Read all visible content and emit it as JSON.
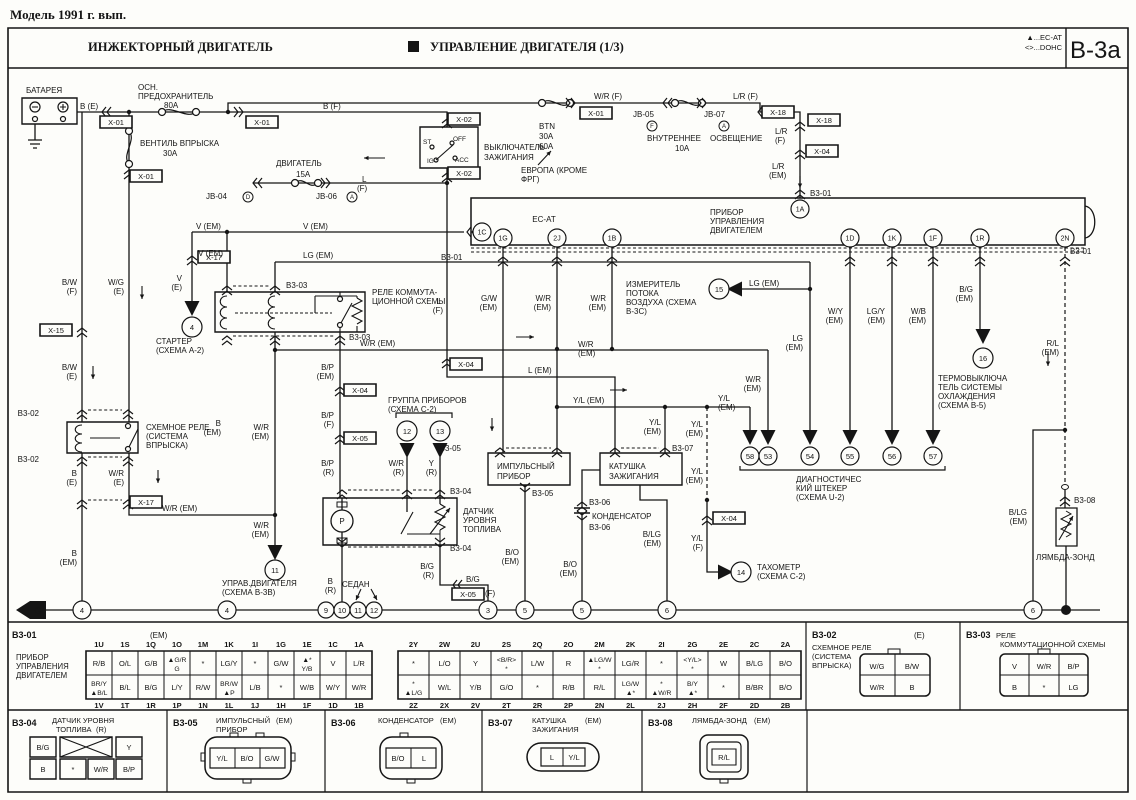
{
  "page": {
    "title": "Модель 1991 г. вып."
  },
  "header": {
    "left": "ИНЖЕКТОРНЫЙ ДВИГАТЕЛЬ",
    "center": "УПРАВЛЕНИЕ ДВИГАТЕЛЯ (1/3)",
    "legend1": "▲...EC-AT",
    "legend2": "<>...DOHC",
    "code": "B-3a"
  },
  "diagram": {
    "labels": [
      [
        "БАТАРЕЯ",
        26,
        93
      ],
      [
        "ОСН.",
        138,
        90
      ],
      [
        "ПРЕДОХРАНИТЕЛЬ",
        138,
        99
      ],
      [
        "80A",
        164,
        108
      ],
      [
        "B (E)",
        80,
        109
      ],
      [
        "B (F)",
        323,
        109
      ],
      [
        "ВЕНТИЛЬ ВПРЫСКА",
        140,
        146
      ],
      [
        "30A",
        163,
        156
      ],
      [
        "ДВИГАТЕЛЬ",
        276,
        166
      ],
      [
        "15A",
        296,
        177
      ],
      [
        "JB-04",
        206,
        199
      ],
      [
        "JB-06",
        316,
        199
      ],
      [
        "L",
        362,
        182
      ],
      [
        "(F)",
        357,
        191
      ],
      [
        "W/R (F)",
        594,
        99
      ],
      [
        "L/R (F)",
        733,
        99
      ],
      [
        "BTN",
        539,
        129
      ],
      [
        "30A",
        539,
        139
      ],
      [
        "60A",
        539,
        149
      ],
      [
        "ЕВРОПА (КРОМЕ",
        521,
        173
      ],
      [
        "ФРГ)",
        521,
        182
      ],
      [
        "JB-05",
        633,
        117
      ],
      [
        "JB-07",
        704,
        117
      ],
      [
        "ВНУТРЕННЕЕ",
        647,
        141
      ],
      [
        "ОСВЕЩЕНИЕ",
        710,
        141
      ],
      [
        "10A",
        675,
        151
      ],
      [
        "ВЫКЛЮЧАТЕЛЬ",
        484,
        150
      ],
      [
        "ЗАЖИГАНИЯ",
        484,
        160
      ],
      [
        "ST",
        423,
        144,
        "s",
        6.5
      ],
      [
        "IG",
        427,
        163,
        "s",
        6.5
      ],
      [
        "OFF",
        453,
        141,
        "s",
        6.5
      ],
      [
        "ACC",
        455,
        162,
        "s",
        6.5
      ],
      [
        "L/R",
        775,
        134
      ],
      [
        "(F)",
        775,
        143
      ],
      [
        "L/R",
        772,
        169
      ],
      [
        "(EM)",
        769,
        178
      ],
      [
        "B3-01",
        810,
        196
      ],
      [
        "EC-AT",
        544,
        222,
        "m"
      ],
      [
        "ПРИБОР",
        710,
        215
      ],
      [
        "УПРАВЛЕНИЯ",
        710,
        224
      ],
      [
        "ДВИГАТЕЛЕМ",
        710,
        233
      ],
      [
        "B3-01",
        441,
        260
      ],
      [
        "B3-01",
        1070,
        254
      ],
      [
        "V (EM)",
        196,
        229
      ],
      [
        "V (EM)",
        303,
        229
      ],
      [
        "V (EM)",
        223,
        256,
        "e"
      ],
      [
        "V",
        182,
        281,
        "e"
      ],
      [
        "(E)",
        182,
        290,
        "e"
      ],
      [
        "СТАРТЕР",
        156,
        344
      ],
      [
        "(СХЕМА A-2)",
        156,
        353
      ],
      [
        "B/W",
        77,
        285,
        "e"
      ],
      [
        "(F)",
        77,
        294,
        "e"
      ],
      [
        "W/G",
        124,
        285,
        "e"
      ],
      [
        "(E)",
        124,
        294,
        "e"
      ],
      [
        "B/W",
        77,
        370,
        "e"
      ],
      [
        "(E)",
        77,
        379,
        "e"
      ],
      [
        "B3-02",
        39,
        416,
        "e"
      ],
      [
        "СХЕМНОЕ РЕЛЕ",
        146,
        430
      ],
      [
        "(СИСТЕМА",
        146,
        439
      ],
      [
        "ВПРЫСКА)",
        146,
        448
      ],
      [
        "B3-02",
        39,
        462,
        "e"
      ],
      [
        "B",
        77,
        476,
        "e"
      ],
      [
        "(E)",
        77,
        485,
        "e"
      ],
      [
        "W/R",
        124,
        476,
        "e"
      ],
      [
        "(E)",
        124,
        485,
        "e"
      ],
      [
        "W/R (EM)",
        162,
        511
      ],
      [
        "B",
        77,
        556,
        "e"
      ],
      [
        "(EM)",
        77,
        565,
        "e"
      ],
      [
        "B",
        221,
        426,
        "e"
      ],
      [
        "(EM)",
        221,
        435,
        "e"
      ],
      [
        "W/R",
        269,
        430,
        "e"
      ],
      [
        "(EM)",
        269,
        439,
        "e"
      ],
      [
        "W/R",
        269,
        528,
        "e"
      ],
      [
        "(EM)",
        269,
        537,
        "e"
      ],
      [
        "УПРАВ.ДВИГАТЕЛЯ",
        222,
        586
      ],
      [
        "(СХЕМА B-3B)",
        222,
        595
      ],
      [
        "B3-03",
        286,
        288
      ],
      [
        "B3-03",
        349,
        340
      ],
      [
        "РЕЛЕ КОММУТА-",
        372,
        295
      ],
      [
        "ЦИОННОЙ СХЕМЫ",
        372,
        304
      ],
      [
        "LG (EM)",
        303,
        258
      ],
      [
        "W/R (EM)",
        360,
        346
      ],
      [
        "B/P",
        334,
        370,
        "e"
      ],
      [
        "(EM)",
        334,
        379,
        "e"
      ],
      [
        "B/P",
        334,
        418,
        "e"
      ],
      [
        "(F)",
        334,
        427,
        "e"
      ],
      [
        "B/P",
        334,
        466,
        "e"
      ],
      [
        "(R)",
        334,
        475,
        "e"
      ],
      [
        "L",
        441,
        304,
        "e"
      ],
      [
        "(F)",
        443,
        313,
        "e"
      ],
      [
        "G/W",
        497,
        301,
        "e"
      ],
      [
        "(EM)",
        497,
        310,
        "e"
      ],
      [
        "W/R",
        551,
        301,
        "e"
      ],
      [
        "(EM)",
        551,
        310,
        "e"
      ],
      [
        "W/R",
        606,
        301,
        "e"
      ],
      [
        "(EM)",
        606,
        310,
        "e"
      ],
      [
        "W/R",
        578,
        347
      ],
      [
        "(EM)",
        578,
        356
      ],
      [
        "L (EM)",
        528,
        373
      ],
      [
        "ГРУППА ПРИБОРОВ",
        388,
        403
      ],
      [
        "(СХЕМА C-2)",
        388,
        412
      ],
      [
        "W/R",
        404,
        466,
        "e"
      ],
      [
        "(R)",
        404,
        475,
        "e"
      ],
      [
        "Y",
        434,
        466,
        "e"
      ],
      [
        "(R)",
        437,
        475,
        "e"
      ],
      [
        "B3-04",
        450,
        494
      ],
      [
        "B3-04",
        450,
        551
      ],
      [
        "ДАТЧИК",
        463,
        514
      ],
      [
        "УРОВНЯ",
        463,
        523
      ],
      [
        "ТОПЛИВА",
        463,
        532
      ],
      [
        "B/G",
        434,
        569,
        "e"
      ],
      [
        "(R)",
        434,
        578,
        "e"
      ],
      [
        "B",
        333,
        584,
        "e"
      ],
      [
        "(R)",
        336,
        593,
        "e"
      ],
      [
        "СЕДАН",
        342,
        587
      ],
      [
        "B/G",
        466,
        582
      ],
      [
        "(F)",
        485,
        596
      ],
      [
        "B3-05",
        461,
        451,
        "e"
      ],
      [
        "ИМПУЛЬСНЫЙ",
        497,
        469
      ],
      [
        "ПРИБОР",
        497,
        479
      ],
      [
        "B3-05",
        532,
        496
      ],
      [
        "B/O",
        519,
        555,
        "e"
      ],
      [
        "(EM)",
        519,
        564,
        "e"
      ],
      [
        "КАТУШКА",
        609,
        469
      ],
      [
        "ЗАЖИГАНИЯ",
        609,
        479
      ],
      [
        "B3-07",
        672,
        451
      ],
      [
        "B3-06",
        589,
        505
      ],
      [
        "КОНДЕНСАТОР",
        592,
        519
      ],
      [
        "B3-06",
        589,
        530
      ],
      [
        "B/O",
        577,
        567,
        "e"
      ],
      [
        "(EM)",
        577,
        576,
        "e"
      ],
      [
        "B/LG",
        661,
        537,
        "e"
      ],
      [
        "(EM)",
        661,
        546,
        "e"
      ],
      [
        "Y/L (EM)",
        573,
        403
      ],
      [
        "Y/L",
        661,
        425,
        "e"
      ],
      [
        "(EM)",
        661,
        434,
        "e"
      ],
      [
        "Y/L",
        703,
        427,
        "e"
      ],
      [
        "(EM)",
        703,
        436,
        "e"
      ],
      [
        "Y/L",
        718,
        401
      ],
      [
        "(EM)",
        718,
        410
      ],
      [
        "Y/L",
        703,
        474,
        "e"
      ],
      [
        "(EM)",
        703,
        483,
        "e"
      ],
      [
        "Y/L",
        703,
        541,
        "e"
      ],
      [
        "(F)",
        703,
        550,
        "e"
      ],
      [
        "ТАХОМЕТР",
        757,
        570
      ],
      [
        "(СХЕМА C-2)",
        757,
        579
      ],
      [
        "ИЗМЕРИТЕЛЬ",
        626,
        287
      ],
      [
        "ПОТОКА",
        626,
        296
      ],
      [
        "ВОЗДУХА (СХЕМА",
        626,
        305
      ],
      [
        "B-3C)",
        626,
        314
      ],
      [
        "LG (EM)",
        749,
        286
      ],
      [
        "LG",
        803,
        341,
        "e"
      ],
      [
        "(EM)",
        803,
        350,
        "e"
      ],
      [
        "W/Y",
        843,
        314,
        "e"
      ],
      [
        "(EM)",
        843,
        323,
        "e"
      ],
      [
        "LG/Y",
        885,
        314,
        "e"
      ],
      [
        "(EM)",
        885,
        323,
        "e"
      ],
      [
        "W/B",
        926,
        314,
        "e"
      ],
      [
        "(EM)",
        926,
        323,
        "e"
      ],
      [
        "B/G",
        973,
        292,
        "e"
      ],
      [
        "(EM)",
        973,
        301,
        "e"
      ],
      [
        "W/R",
        761,
        382,
        "e"
      ],
      [
        "(EM)",
        761,
        391,
        "e"
      ],
      [
        "ТЕРМОВЫКЛЮЧА",
        938,
        381
      ],
      [
        "ТЕЛЬ СИСТЕМЫ",
        938,
        390
      ],
      [
        "ОХЛАЖДЕНИЯ",
        938,
        399
      ],
      [
        "(СХЕМА B-5)",
        938,
        408
      ],
      [
        "ДИАГНОСТИЧЕС",
        796,
        482
      ],
      [
        "КИЙ ШТЕКЕР",
        796,
        491
      ],
      [
        "(СХЕМА U-2)",
        796,
        500
      ],
      [
        "R/L",
        1059,
        346,
        "e"
      ],
      [
        "(EM)",
        1059,
        355,
        "e"
      ],
      [
        "B/LG",
        1027,
        515,
        "e"
      ],
      [
        "(EM)",
        1027,
        524,
        "e"
      ],
      [
        "B3-08",
        1074,
        503
      ],
      [
        "ЛЯМБДА-ЗОНД",
        1036,
        560
      ],
      [
        "P",
        342,
        524,
        "m"
      ]
    ],
    "inline_connectors": [
      [
        "X-01",
        116,
        122
      ],
      [
        "X-01",
        146,
        176
      ],
      [
        "X-01",
        262,
        122
      ],
      [
        "X-02",
        464,
        119
      ],
      [
        "X-02",
        464,
        173
      ],
      [
        "X-01",
        596,
        113
      ],
      [
        "X-18",
        778,
        112
      ],
      [
        "X-18",
        824,
        120
      ],
      [
        "X-04",
        822,
        151
      ],
      [
        "X-17",
        214,
        257
      ],
      [
        "X-15",
        56,
        330
      ],
      [
        "X-17",
        146,
        502
      ],
      [
        "X-04",
        360,
        390
      ],
      [
        "X-05",
        360,
        438
      ],
      [
        "X-04",
        466,
        364
      ],
      [
        "X-05",
        468,
        594
      ],
      [
        "X-04",
        729,
        518
      ]
    ],
    "pins": [
      [
        "1A",
        800,
        209
      ],
      [
        "1C",
        482,
        232
      ],
      [
        "1G",
        503,
        238
      ],
      [
        "2J",
        557,
        238
      ],
      [
        "1B",
        612,
        238
      ],
      [
        "1D",
        850,
        238
      ],
      [
        "1K",
        892,
        238
      ],
      [
        "1F",
        933,
        238
      ],
      [
        "1R",
        980,
        238
      ],
      [
        "2N",
        1065,
        238
      ]
    ],
    "callout_circles": [
      [
        "4",
        192,
        327,
        10
      ],
      [
        "11",
        275,
        570,
        10
      ],
      [
        "12",
        407,
        431,
        10
      ],
      [
        "13",
        440,
        431,
        10
      ],
      [
        "14",
        741,
        572,
        10
      ],
      [
        "15",
        719,
        289,
        10
      ],
      [
        "16",
        983,
        358,
        10
      ],
      [
        "58",
        750,
        456,
        9
      ],
      [
        "53",
        768,
        456,
        9
      ],
      [
        "54",
        810,
        456,
        9
      ],
      [
        "55",
        850,
        456,
        9
      ],
      [
        "56",
        892,
        456,
        9
      ],
      [
        "57",
        933,
        456,
        9
      ]
    ],
    "ground_circles": [
      [
        "4",
        82,
        610,
        9
      ],
      [
        "4",
        227,
        610,
        9
      ],
      [
        "9",
        326,
        610,
        8
      ],
      [
        "10",
        342,
        610,
        8
      ],
      [
        "11",
        358,
        610,
        8
      ],
      [
        "12",
        374,
        610,
        8
      ],
      [
        "3",
        488,
        610,
        9
      ],
      [
        "5",
        525,
        610,
        9
      ],
      [
        "5",
        582,
        610,
        9
      ],
      [
        "6",
        667,
        610,
        9
      ],
      [
        "6",
        1033,
        610,
        9
      ]
    ],
    "letter_circles": [
      [
        "D",
        248,
        197
      ],
      [
        "A",
        352,
        197
      ],
      [
        "F",
        652,
        126
      ],
      [
        "A",
        724,
        126
      ]
    ],
    "ground_tag": "G"
  },
  "tables": {
    "b301": {
      "code": "B3-01",
      "suffix": "(EM)",
      "device": [
        "ПРИБОР",
        "УПРАВЛЕНИЯ",
        "ДВИГАТЕЛЕМ"
      ],
      "grid1": {
        "top_pins": [
          "1U",
          "1S",
          "1Q",
          "1O",
          "1M",
          "1K",
          "1I",
          "1G",
          "1E",
          "1C",
          "1A"
        ],
        "top_vals": [
          "R/B",
          "O/L",
          "G/B",
          "▲G/R|G",
          "*",
          "LG/Y",
          "*",
          "G/W",
          "▲*|Y/B",
          "V",
          "L/R"
        ],
        "bot_vals": [
          "BR/Y|▲B/L",
          "B/L",
          "B/G",
          "L/Y",
          "R/W",
          "BR/W|▲P",
          "L/B",
          "*",
          "W/B",
          "W/Y",
          "W/R"
        ],
        "bot_pins": [
          "1V",
          "1T",
          "1R",
          "1P",
          "1N",
          "1L",
          "1J",
          "1H",
          "1F",
          "1D",
          "1B"
        ]
      },
      "grid2": {
        "top_pins": [
          "2Y",
          "2W",
          "2U",
          "2S",
          "2Q",
          "2O",
          "2M",
          "2K",
          "2I",
          "2G",
          "2E",
          "2C",
          "2A"
        ],
        "top_vals": [
          "*",
          "L/O",
          "Y",
          "<B/R>|*",
          "L/W",
          "R",
          "▲LG/W|*",
          "LG/R",
          "*",
          "<Y/L>|*",
          "W",
          "B/LG",
          "B/O"
        ],
        "bot_vals": [
          "*|▲L/G",
          "W/L",
          "Y/B",
          "G/O",
          "*",
          "R/B",
          "R/L",
          "LG/W|▲*",
          "*|▲W/R",
          "B/Y|▲*",
          "*",
          "B/BR",
          "B/O"
        ],
        "bot_pins": [
          "2Z",
          "2X",
          "2V",
          "2T",
          "2R",
          "2P",
          "2N",
          "2L",
          "2J",
          "2H",
          "2F",
          "2D",
          "2B"
        ]
      }
    },
    "b302": {
      "code": "B3-02",
      "suffix": "(E)",
      "device": [
        "СХЕМНОЕ РЕЛЕ",
        "(СИСТЕМА",
        "ВПРЫСКА)"
      ],
      "rows": [
        [
          "W/G",
          "B/W"
        ],
        [
          "W/R",
          "B"
        ]
      ]
    },
    "b303": {
      "code": "B3-03",
      "device": [
        "РЕЛЕ",
        "КОММУТАЦИОННОЙ СХЕМЫ"
      ],
      "rows": [
        [
          "V",
          "W/R",
          "B/P"
        ],
        [
          "B",
          "*",
          "LG"
        ]
      ]
    },
    "b304": {
      "code": "B3-04",
      "device1": "ДАТЧИК УРОВНЯ",
      "device2": "ТОПЛИВА",
      "device3": "(R)",
      "top": [
        "B/G",
        "✕",
        "Y"
      ],
      "bot": [
        "B",
        "*",
        "W/R",
        "B/P"
      ]
    },
    "b305": {
      "code": "B3-05",
      "device1": "ИМПУЛЬСНЫЙ",
      "suffix": "(EM)",
      "device2": "ПРИБОР",
      "pins": [
        "Y/L",
        "B/O",
        "G/W"
      ]
    },
    "b306": {
      "code": "B3-06",
      "device1": "КОНДЕНСАТОР",
      "suffix": "(EM)",
      "pins": [
        "B/O",
        "L"
      ]
    },
    "b307": {
      "code": "B3-07",
      "device1": "КАТУШКА",
      "suffix": "(EM)",
      "device2": "ЗАЖИГАНИЯ",
      "pins": [
        "L",
        "Y/L"
      ]
    },
    "b308": {
      "code": "B3-08",
      "device1": "ЛЯМБДА-ЗОНД",
      "suffix": "(EM)",
      "pins": [
        "R/L"
      ]
    }
  },
  "colors": {
    "ink": "#151515",
    "paper": "#fdfdfa"
  }
}
